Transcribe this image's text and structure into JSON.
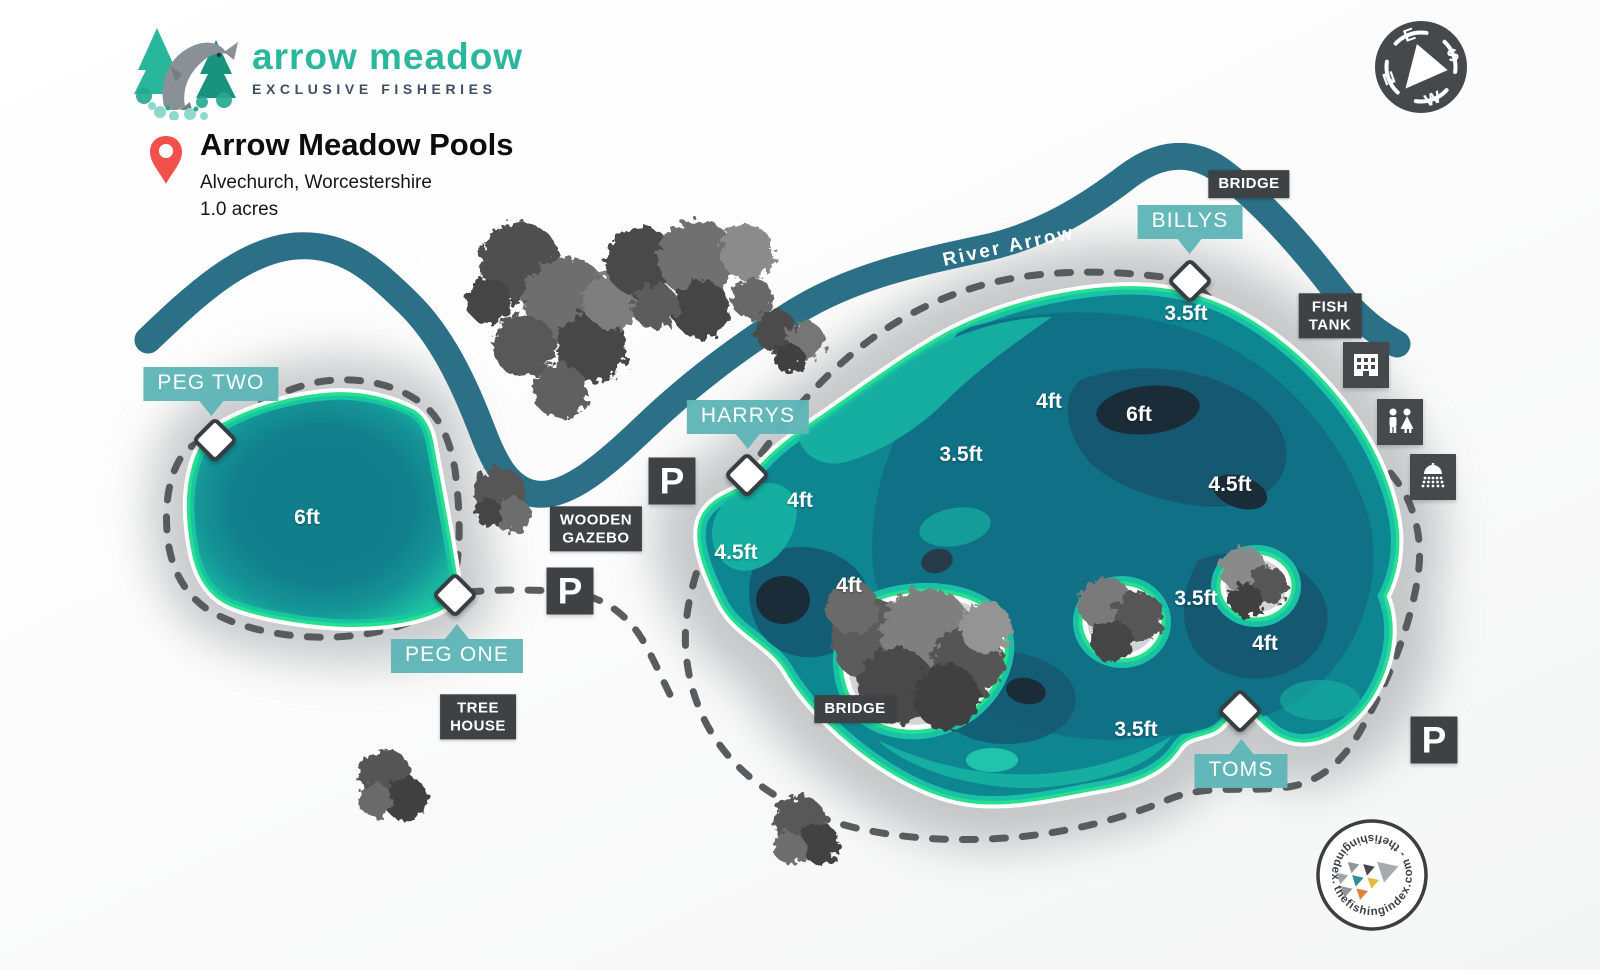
{
  "header": {
    "brand": "arrow meadow",
    "tagline": "EXCLUSIVE FISHERIES",
    "title": "Arrow Meadow Pools",
    "location": "Alvechurch, Worcestershire",
    "area": "1.0 acres"
  },
  "compass": {
    "top": "E",
    "right": "S",
    "bottom": "W",
    "left": "N"
  },
  "river": {
    "label_upper": "River Arrow",
    "label_lower": "River Arrow"
  },
  "pegs": {
    "peg_two": "PEG TWO",
    "peg_one": "PEG ONE",
    "harrys": "HARRYS",
    "billys": "BILLYS",
    "toms": "TOMS"
  },
  "features": {
    "bridge_top": "BRIDGE",
    "bridge_island": "BRIDGE",
    "fish_tank": "FISH\nTANK",
    "wooden_gazebo": "WOODEN\nGAZEBO",
    "tree_house": "TREE\nHOUSE"
  },
  "parking": {
    "label": "P"
  },
  "depths": {
    "pool": "6ft",
    "top": "3.5ft",
    "mid_4ft": "4ft",
    "deep_6ft": "6ft",
    "mid_35": "3.5ft",
    "left_4ft": "4ft",
    "left_45": "4.5ft",
    "center_4ft": "4ft",
    "right_45": "4.5ft",
    "right_35": "3.5ft",
    "lower_4ft": "4ft",
    "bottom_35": "3.5ft"
  },
  "footer": {
    "ring_text": "thefishingindex.com  -  thefishingindex.com  -"
  },
  "colors": {
    "brand_teal": "#2ab79c",
    "river": "#2b7086",
    "badge_teal": "#5fb6b7",
    "badge_dark": "#3f4245",
    "shore_green": "#27df8e",
    "lake_body": "#0d8692",
    "lake_deep": "#1b2c39",
    "pin_red": "#f2504b"
  }
}
